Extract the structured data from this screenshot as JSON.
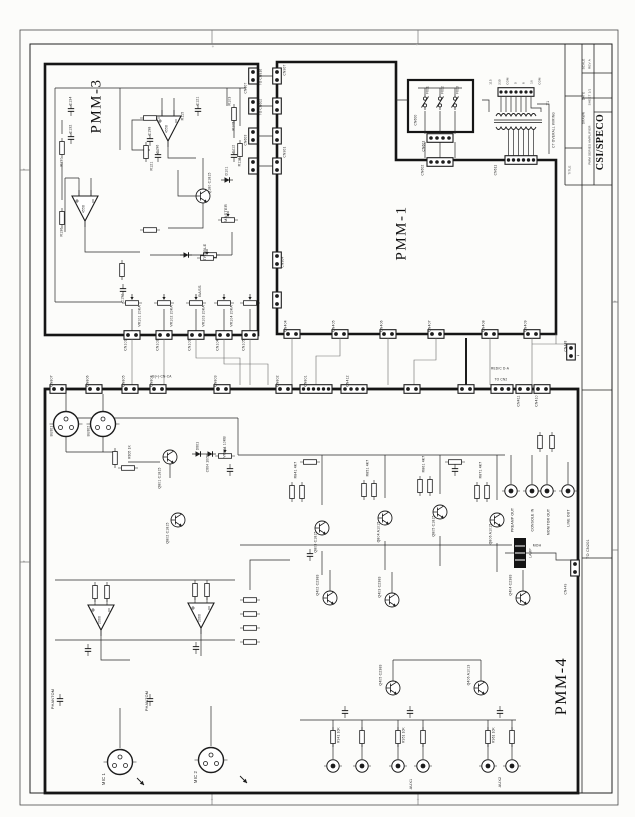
{
  "document": {
    "kind": "scanned amplifier schematic sheet"
  },
  "title_block": {
    "company": "CSI/SPECO"
  },
  "boards": {
    "pmm3": "PMM-3",
    "pmm1": "PMM-1",
    "pmm4": "PMM-4"
  },
  "labels": [
    {
      "t": "TITLE",
      "x": 570,
      "y": 170,
      "s": 3,
      "n": "titleblock-field"
    },
    {
      "t": "DRAWN",
      "x": 584,
      "y": 118,
      "s": 3,
      "n": "titleblock-field"
    },
    {
      "t": "DATE",
      "x": 584,
      "y": 96,
      "s": 3,
      "n": "titleblock-field"
    },
    {
      "t": "SCALE",
      "x": 584,
      "y": 64,
      "s": 3,
      "n": "titleblock-field"
    },
    {
      "t": "REV A",
      "x": 590,
      "y": 64,
      "s": 3,
      "n": "titleblock-field"
    },
    {
      "t": "SHEET 1/1",
      "x": 590,
      "y": 97,
      "s": 3,
      "n": "titleblock-field"
    },
    {
      "t": "PMM SERIES AMPLIFIER",
      "x": 590,
      "y": 145,
      "s": 3,
      "n": "titleblock-field"
    },
    {
      "t": "C134",
      "x": 71,
      "y": 101,
      "n": "ref-c134"
    },
    {
      "t": "C132",
      "x": 71,
      "y": 129
    },
    {
      "t": "R130",
      "x": 62,
      "y": 162
    },
    {
      "t": "R136",
      "x": 62,
      "y": 232
    },
    {
      "t": "C190",
      "x": 123,
      "y": 298
    },
    {
      "t": "Q180 C1815",
      "x": 210,
      "y": 183
    },
    {
      "t": "R121",
      "x": 152,
      "y": 166
    },
    {
      "t": "C198",
      "x": 150,
      "y": 131
    },
    {
      "t": "C196",
      "x": 158,
      "y": 149
    },
    {
      "t": "R115",
      "x": 183,
      "y": 116
    },
    {
      "t": "C121",
      "x": 198,
      "y": 101
    },
    {
      "t": "R103",
      "x": 230,
      "y": 101
    },
    {
      "t": "R105",
      "x": 234,
      "y": 126
    },
    {
      "t": "C112",
      "x": 234,
      "y": 149
    },
    {
      "t": "R116",
      "x": 240,
      "y": 162
    },
    {
      "t": "D101",
      "x": 227,
      "y": 171
    },
    {
      "t": "4558",
      "x": 167,
      "y": 129,
      "s": 3.2
    },
    {
      "t": "4558",
      "x": 84,
      "y": 209,
      "s": 3.2
    },
    {
      "t": "MASTER",
      "x": 226,
      "y": 213,
      "s": 4,
      "n": "label-master"
    },
    {
      "t": "TREBLE",
      "x": 205,
      "y": 252,
      "s": 4,
      "n": "label-treble"
    },
    {
      "t": "BASS",
      "x": 200,
      "y": 291,
      "s": 4,
      "n": "label-bass"
    },
    {
      "t": "VR101 20KA",
      "x": 140,
      "y": 316
    },
    {
      "t": "VR102 20KA",
      "x": 172,
      "y": 316
    },
    {
      "t": "VR103 20KA",
      "x": 204,
      "y": 316
    },
    {
      "t": "VR104 20KA",
      "x": 232,
      "y": 316
    },
    {
      "t": "CN101",
      "x": 126,
      "y": 345
    },
    {
      "t": "CN102",
      "x": 158,
      "y": 345
    },
    {
      "t": "CN103",
      "x": 190,
      "y": 345
    },
    {
      "t": "CN104",
      "x": 218,
      "y": 345
    },
    {
      "t": "CN105",
      "x": 244,
      "y": 345
    },
    {
      "t": "TO CN816",
      "x": 261,
      "y": 77,
      "s": 3.2
    },
    {
      "t": "TO CN602",
      "x": 261,
      "y": 107,
      "s": 3.2
    },
    {
      "t": "CN607",
      "x": 246,
      "y": 88,
      "s": 3.2
    },
    {
      "t": "CN603",
      "x": 246,
      "y": 140,
      "s": 3.2
    },
    {
      "t": "CN907",
      "x": 285,
      "y": 70,
      "s": 3.2
    },
    {
      "t": "CN901",
      "x": 285,
      "y": 152,
      "s": 3.2
    },
    {
      "t": "CN904",
      "x": 283,
      "y": 262,
      "s": 3.2
    },
    {
      "t": "CN404",
      "x": 286,
      "y": 326
    },
    {
      "t": "CN405",
      "x": 334,
      "y": 326
    },
    {
      "t": "CN406",
      "x": 382,
      "y": 326
    },
    {
      "t": "CN407",
      "x": 430,
      "y": 326
    },
    {
      "t": "CN408",
      "x": 484,
      "y": 326
    },
    {
      "t": "CN409",
      "x": 526,
      "y": 326
    },
    {
      "t": "CN600",
      "x": 416,
      "y": 120,
      "s": 3.2
    },
    {
      "t": "F601",
      "x": 428,
      "y": 90,
      "s": 3.2
    },
    {
      "t": "F602",
      "x": 443,
      "y": 90,
      "s": 3.2
    },
    {
      "t": "F603",
      "x": 458,
      "y": 90,
      "s": 3.2
    },
    {
      "t": "CN601",
      "x": 424,
      "y": 146,
      "s": 3.2
    },
    {
      "t": "CN602",
      "x": 423,
      "y": 170,
      "s": 3.2
    },
    {
      "t": "115",
      "x": 491,
      "y": 82,
      "s": 3
    },
    {
      "t": "230",
      "x": 500,
      "y": 82,
      "s": 3
    },
    {
      "t": "COM",
      "x": 508,
      "y": 81,
      "s": 2.8
    },
    {
      "t": "0",
      "x": 516,
      "y": 83,
      "s": 3
    },
    {
      "t": "8",
      "x": 524,
      "y": 83,
      "s": 3
    },
    {
      "t": "16",
      "x": 532,
      "y": 82,
      "s": 3
    },
    {
      "t": "COM",
      "x": 540,
      "y": 81,
      "s": 2.8
    },
    {
      "t": "T1",
      "x": 549,
      "y": 103,
      "s": 3.8
    },
    {
      "t": "CT OVERALL WIRING",
      "x": 554,
      "y": 130,
      "s": 3.2
    },
    {
      "t": "CN611",
      "x": 496,
      "y": 170,
      "s": 3.2
    },
    {
      "t": "BU801",
      "x": 52,
      "y": 431,
      "s": 3.2
    },
    {
      "t": "BU802",
      "x": 89,
      "y": 431,
      "s": 3.2
    },
    {
      "t": "CN807",
      "x": 52,
      "y": 381
    },
    {
      "t": "CN806",
      "x": 88,
      "y": 381
    },
    {
      "t": "CN805",
      "x": 124,
      "y": 381
    },
    {
      "t": "CN804",
      "x": 152,
      "y": 381
    },
    {
      "t": "CN803",
      "x": 216,
      "y": 381
    },
    {
      "t": "CN802",
      "x": 278,
      "y": 381
    },
    {
      "t": "CN801",
      "x": 306,
      "y": 381
    },
    {
      "t": "CN412",
      "x": 348,
      "y": 381
    },
    {
      "t": "CN411",
      "x": 519,
      "y": 401
    },
    {
      "t": "CN410",
      "x": 537,
      "y": 401
    },
    {
      "t": "RED/C D-A",
      "x": 500,
      "y": 369,
      "r": 0,
      "s": 3.2
    },
    {
      "t": "TO CN2",
      "x": 501,
      "y": 380,
      "r": 0,
      "s": 3.2
    },
    {
      "t": "B(+)-CN-CA",
      "x": 162,
      "y": 377,
      "r": 0,
      "s": 3.2
    },
    {
      "t": "Q801 C1815",
      "x": 160,
      "y": 478
    },
    {
      "t": "Q802 C1815",
      "x": 168,
      "y": 533
    },
    {
      "t": "VR801 10KB",
      "x": 225,
      "y": 447
    },
    {
      "t": "D801",
      "x": 198,
      "y": 446,
      "s": 3.2
    },
    {
      "t": "C804 10/50",
      "x": 208,
      "y": 463,
      "s": 3.2
    },
    {
      "t": "R805 1K",
      "x": 130,
      "y": 452,
      "s": 3.2
    },
    {
      "t": "R841 4K7",
      "x": 296,
      "y": 470
    },
    {
      "t": "R851 4K7",
      "x": 368,
      "y": 468
    },
    {
      "t": "R861 4K7",
      "x": 424,
      "y": 464
    },
    {
      "t": "R871 4K7",
      "x": 481,
      "y": 470
    },
    {
      "t": "Q803 C1815",
      "x": 316,
      "y": 542
    },
    {
      "t": "Q804 A1015",
      "x": 379,
      "y": 532
    },
    {
      "t": "Q805 C1815",
      "x": 434,
      "y": 526
    },
    {
      "t": "Q806 A1015",
      "x": 491,
      "y": 534
    },
    {
      "t": "Q402 C2383",
      "x": 318,
      "y": 585
    },
    {
      "t": "Q403 C2383",
      "x": 380,
      "y": 587
    },
    {
      "t": "Q404 C2383",
      "x": 511,
      "y": 585
    },
    {
      "t": "Q405 C2383",
      "x": 381,
      "y": 675
    },
    {
      "t": "Q406 A1013",
      "x": 469,
      "y": 675
    },
    {
      "t": "MOH",
      "x": 537,
      "y": 546,
      "r": 0,
      "s": 3.4,
      "n": "label-moh"
    },
    {
      "t": "LAMP",
      "x": 531,
      "y": 553,
      "s": 3.2,
      "n": "label-lamp"
    },
    {
      "t": "TO CN201",
      "x": 589,
      "y": 549,
      "s": 3.8
    },
    {
      "t": "CN449",
      "x": 566,
      "y": 589,
      "s": 3.2
    },
    {
      "t": "CN448",
      "x": 566,
      "y": 346,
      "s": 3.2
    },
    {
      "t": "~",
      "x": 578,
      "y": 357,
      "r": 0,
      "s": 5,
      "n": "ac-symbol"
    },
    {
      "t": "PREAMP OUT",
      "x": 513,
      "y": 520,
      "n": "label-preamp-out"
    },
    {
      "t": "CONSOLE IN",
      "x": 533,
      "y": 520,
      "n": "label-console-in"
    },
    {
      "t": "MONITOR OUT",
      "x": 549,
      "y": 522,
      "n": "label-monitor-out"
    },
    {
      "t": "LINE OUT",
      "x": 569,
      "y": 518,
      "n": "label-line-out"
    },
    {
      "t": "2068",
      "x": 100,
      "y": 620,
      "s": 3.2
    },
    {
      "t": "2068",
      "x": 200,
      "y": 618,
      "s": 3.2
    },
    {
      "t": "PHANTOM",
      "x": 54,
      "y": 699,
      "s": 3.8,
      "n": "label-phantom"
    },
    {
      "t": "PHANTOM",
      "x": 148,
      "y": 701,
      "s": 3.8,
      "n": "label-phantom"
    },
    {
      "t": "MIC 1",
      "x": 104,
      "y": 779,
      "s": 4.2,
      "n": "label-mic1"
    },
    {
      "t": "MIC 2",
      "x": 196,
      "y": 777,
      "s": 4.2,
      "n": "label-mic2"
    },
    {
      "t": "AUX1",
      "x": 412,
      "y": 784,
      "s": 3.8,
      "n": "label-aux1"
    },
    {
      "t": "AUX2",
      "x": 501,
      "y": 782,
      "s": 3.8,
      "n": "label-aux2"
    },
    {
      "t": "R941 10K",
      "x": 339,
      "y": 735,
      "s": 3.2
    },
    {
      "t": "R951 10K",
      "x": 404,
      "y": 735,
      "s": 3.2
    },
    {
      "t": "R961 10K",
      "x": 494,
      "y": 735,
      "s": 3.2
    },
    {
      "t": "+",
      "x": 213,
      "y": 47,
      "r": 0,
      "s": 4.5,
      "c": "#8a8a8a",
      "n": "zone-mark"
    },
    {
      "t": "+",
      "x": 417,
      "y": 45,
      "r": 0,
      "s": 4.5,
      "c": "#8a8a8a",
      "n": "zone-mark"
    },
    {
      "t": "+",
      "x": 24,
      "y": 170,
      "r": 0,
      "s": 4.5,
      "c": "#8a8a8a",
      "n": "zone-mark"
    },
    {
      "t": "+",
      "x": 24,
      "y": 562,
      "r": 0,
      "s": 4.5,
      "c": "#8a8a8a",
      "n": "zone-mark"
    },
    {
      "t": "+",
      "x": 615,
      "y": 302,
      "r": 0,
      "s": 4.5,
      "c": "#8a8a8a",
      "n": "zone-mark"
    },
    {
      "t": "+",
      "x": 212,
      "y": 800,
      "r": 0,
      "s": 4.5,
      "c": "#8a8a8a",
      "n": "zone-mark"
    },
    {
      "t": "+",
      "x": 418,
      "y": 800,
      "r": 0,
      "s": 4.5,
      "c": "#8a8a8a",
      "n": "zone-mark"
    }
  ]
}
